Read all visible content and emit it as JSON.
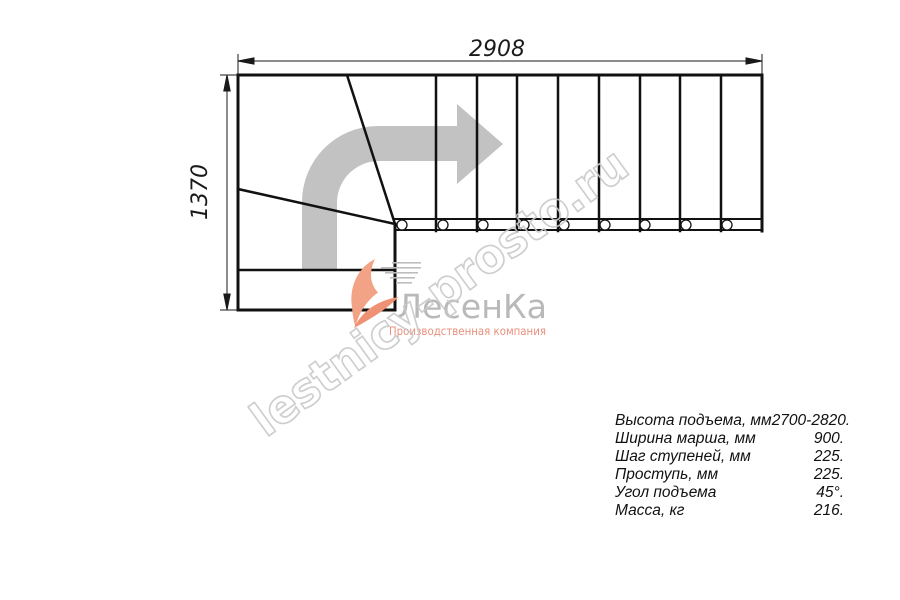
{
  "drawing": {
    "dim_width": "2908",
    "dim_height": "1370"
  },
  "watermark": {
    "text": "lestnicy-prosto.ru",
    "stroke_color": "#c9c9c9"
  },
  "logo": {
    "name": "ЛесенКа",
    "tagline": "Производственная компания",
    "name_color": "#b9b9b9",
    "accent_color": "#ef9273",
    "tagline_color": "#e98f7c"
  },
  "plan": {
    "flight_steps": 9,
    "winder_steps": 3,
    "arrow_color": "#c2c2c2",
    "line_color": "#111111"
  },
  "specs": {
    "rows": [
      {
        "label": "Высота подъема, мм",
        "value": "2700-2820."
      },
      {
        "label": "Ширина марша, мм",
        "value": "900."
      },
      {
        "label": "Шаг ступеней, мм",
        "value": "225."
      },
      {
        "label": "Проступь, мм",
        "value": "225."
      },
      {
        "label": "Угол подъема",
        "value": "45°."
      },
      {
        "label": "Масса, кг",
        "value": "216."
      }
    ]
  }
}
